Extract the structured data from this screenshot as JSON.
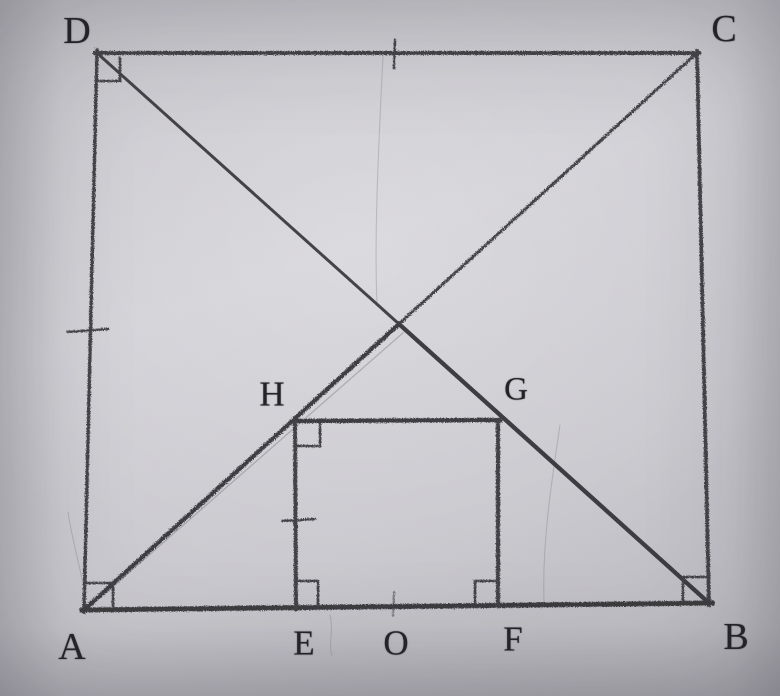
{
  "labels": {
    "A": "A",
    "B": "B",
    "C": "C",
    "D": "D",
    "E": "E",
    "F": "F",
    "G": "G",
    "H": "H",
    "O": "O"
  },
  "figure": {
    "type": "hand-drawn pencil geometry diagram (photographed paper)",
    "outer_square": {
      "vertices": [
        "D",
        "C",
        "B",
        "A"
      ],
      "diagonals": [
        "AC",
        "BD"
      ]
    },
    "inner_square": {
      "vertices": [
        "H",
        "G",
        "F",
        "E"
      ],
      "base_on": "AB",
      "H_on": "AC",
      "G_on": "BD"
    },
    "collinear_points_on_AB": [
      "A",
      "E",
      "O",
      "F",
      "B"
    ],
    "right_angle_marks_at": [
      "D",
      "A",
      "B",
      "H",
      "E",
      "F"
    ],
    "equal_tick_marks_at": [
      "midpoint of DC",
      "midpoint of AD",
      "midpoint of HE",
      "O on AB"
    ]
  }
}
